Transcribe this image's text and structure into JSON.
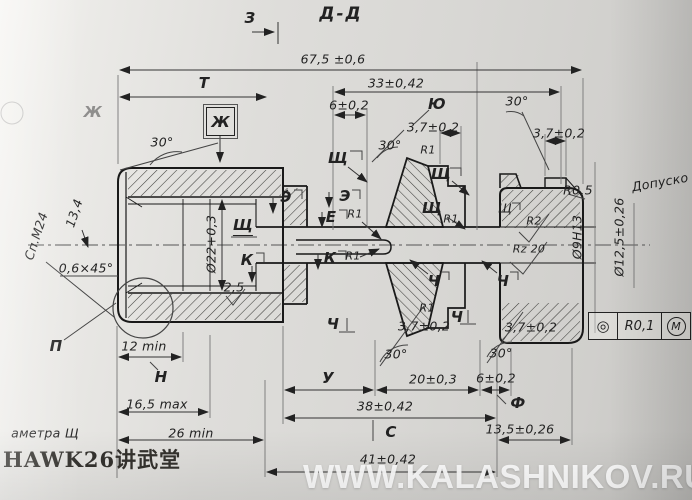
{
  "labels": {
    "view_arrow": "З",
    "section_title": "Д-Д",
    "dim_overall": "67,5 ±0,6",
    "dim_t": "Т",
    "dim_33": "33±0,42",
    "dim_6_top": "6±0,2",
    "label_yu": "Ю",
    "angle_30_top_right": "30°",
    "dim_37_top_a": "3,7±0,2",
    "dim_37_top_b": "3,7±0,2",
    "label_zh": "Ж",
    "label_zh_faint": "Ж",
    "angle_30_left": "30°",
    "angle_30_mid": "30°",
    "r1_top": "R1",
    "label_shch_1": "Щ",
    "label_shch_2": "Щ",
    "label_shch_3": "Щ",
    "label_shch_4": "Щ",
    "label_shch_5": "Щ",
    "r1_shch": "R1",
    "label_e_1": "Э",
    "label_e_2": "Э",
    "label_ye": "Е",
    "r1_e": "R1",
    "label_k_1": "К",
    "label_k_2": "К",
    "r1_k": "R1",
    "rough_25": "2,5",
    "thread": "Сп.М24",
    "dim_134": "13,4",
    "chamfer": "0,6×45°",
    "dia_22": "Ø22+0,3",
    "flag_r2": "R2",
    "flag_rz20": "Rz 20",
    "r_05": "R0,5",
    "note_dopusk": "Допуско",
    "dia_9": "Ø9Н13",
    "dia_125": "Ø12,5±0,26",
    "label_p": "П",
    "dim_12min": "12 min",
    "label_n": "Н",
    "dim_165max": "16,5 max",
    "dim_26min": "26 min",
    "note_ametra": "аметра Щ",
    "label_ch_1": "Ч",
    "label_ch_2": "Ч",
    "label_ch_3": "Ч",
    "label_ch_4": "Ч",
    "r1_bottom": "R1",
    "dim_37_bot_a": "3,7±0,2",
    "dim_37_bot_b": "3,7±0,2",
    "angle_30_bot_c": "30°",
    "angle_30_bot_r": "30°",
    "label_u": "У",
    "dim_20": "20±0,3",
    "dim_38": "38±0,42",
    "label_s": "С",
    "dim_41": "41±0,42",
    "dim_6_bot": "6±0,2",
    "label_f": "Ф",
    "dim_135": "13,5±0,26",
    "fcf_symbol": "◎",
    "fcf_value": "R0,1",
    "fcf_modifier": "М",
    "watermark_left": "HAWK26讲武堂",
    "watermark_right": "WWW.KALASHNIKOV.RU"
  }
}
